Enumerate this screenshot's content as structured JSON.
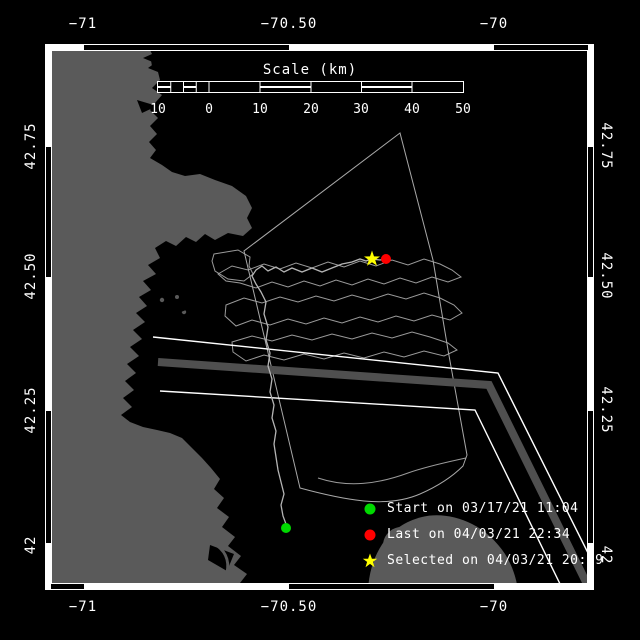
{
  "title": "Drifter track map",
  "axes": {
    "lon": [
      "−71",
      "−70.50",
      "−70"
    ],
    "lat": [
      "42.75",
      "42.50",
      "42.25",
      "42"
    ]
  },
  "scale_bar": {
    "title": "Scale (km)",
    "ticks": [
      "10",
      "0",
      "10",
      "20",
      "30",
      "40",
      "50"
    ]
  },
  "legend": {
    "items": [
      {
        "marker": "circle-icon",
        "color": "#00d900",
        "label": "Start on 03/17/21 11:04"
      },
      {
        "marker": "circle-icon",
        "color": "#ff0000",
        "label": "Last on 04/03/21 22:34"
      },
      {
        "marker": "star-icon",
        "color": "#ffff00",
        "label": "Selected on 04/03/21 20:19"
      }
    ]
  },
  "colors": {
    "background": "#000000",
    "frame": "#ffffff",
    "land": "#5a5a5a",
    "contour": "#9a9a9a",
    "boundary": "#a8a8a8",
    "track": "#b4b4b4",
    "tss_line": "#ffffff",
    "tss_zone": "#4f4f4f",
    "start": "#00d900",
    "last": "#ff0000",
    "selected": "#ffff00"
  }
}
